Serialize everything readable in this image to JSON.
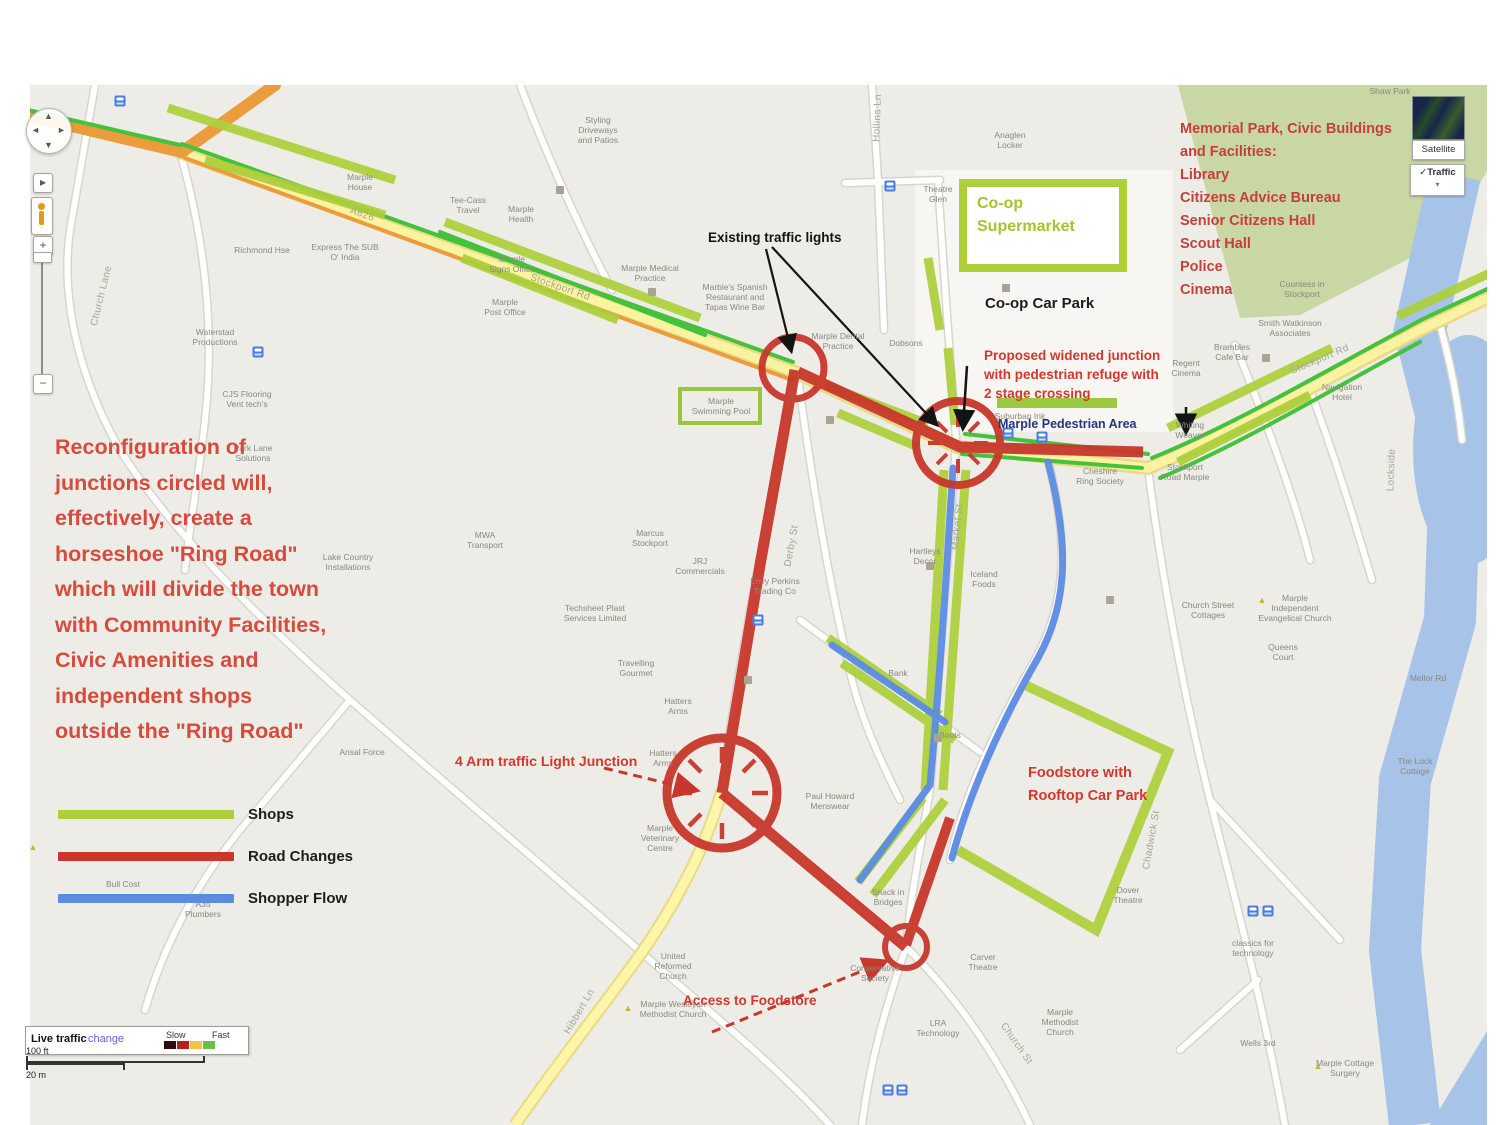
{
  "annotations": {
    "reconfiguration": "Reconfiguration of\njunctions circled will,\neffectively, create a\nhorseshoe \"Ring Road\"\nwhich will divide the town\nwith Community Facilities,\nCivic Amenities and\nindependent shops\noutside the \"Ring Road\"",
    "memorial_park": "Memorial Park, Civic Buildings\nand Facilities:\nLibrary\nCitizens Advice Bureau\nSenior Citizens Hall\nScout Hall\nPolice\nCinema",
    "proposed_junction": "Proposed widened junction\nwith pedestrian refuge with\n2 stage crossing",
    "four_arm_junction": "4 Arm traffic Light Junction",
    "foodstore": "Foodstore with\nRooftop Car Park",
    "access_foodstore": "Access to Foodstore",
    "existing_lights": "Existing traffic lights",
    "coop_supermarket": "Co-op\nSupermarket",
    "coop_car_park": "Co-op Car Park",
    "pedestrian_area": "Marple Pedestrian Area"
  },
  "legend": {
    "items": [
      {
        "label": "Shops",
        "key": "shops"
      },
      {
        "label": "Road Changes",
        "key": "road_changes"
      },
      {
        "label": "Shopper Flow",
        "key": "shopper_flow"
      }
    ]
  },
  "colors": {
    "shops": "#accf3a",
    "road_changes": "#c8372b",
    "shopper_flow": "#5b8ce4",
    "annotation_red": "#d5372c",
    "park_green": "#c8d7a3",
    "water_blue": "#a7c3e8",
    "main_road_yellow": "#fbf3a2",
    "traffic_orange": "#eb9c3c",
    "traffic_green": "#45c13c"
  },
  "controls": {
    "satellite_label": "Satellite",
    "traffic_label": "✓Traffic",
    "dropdown_caret": "▾",
    "pan_up": "▲",
    "pan_down": "▼",
    "pan_left": "◄",
    "pan_right": "►",
    "zoom_in": "+",
    "zoom_out": "−",
    "street_view": "▸"
  },
  "traffic_bar": {
    "title": "Live traffic",
    "link": "change",
    "slow": "Slow",
    "fast": "Fast",
    "swatches": [
      "#2e0d0d",
      "#b81f1f",
      "#f0c541",
      "#6abf4b"
    ]
  },
  "scale": {
    "imperial": "100 ft",
    "metric": "20 m"
  },
  "map_labels": [
    {
      "t": "Styling\nDriveways\nand Patios",
      "x": 598,
      "y": 130
    },
    {
      "t": "Marple\nHouse",
      "x": 360,
      "y": 182
    },
    {
      "t": "Tee-Cass\nTravel",
      "x": 468,
      "y": 205
    },
    {
      "t": "Marple\nHealth",
      "x": 521,
      "y": 214
    },
    {
      "t": "Richmond Hse",
      "x": 262,
      "y": 250
    },
    {
      "t": "Marple\nSigns Office",
      "x": 512,
      "y": 264
    },
    {
      "t": "Express The SUB\nO' India",
      "x": 345,
      "y": 252
    },
    {
      "t": "Marple Medical\nPractice",
      "x": 650,
      "y": 273
    },
    {
      "t": "Marple\nPost Office",
      "x": 505,
      "y": 307
    },
    {
      "t": "Marble's Spanish\nRestaurant and\nTapas Wine Bar",
      "x": 735,
      "y": 297
    },
    {
      "t": "Marple Dental\nPractice",
      "x": 838,
      "y": 341
    },
    {
      "t": "Dobsons",
      "x": 906,
      "y": 343
    },
    {
      "t": "Anaglen\nLocker",
      "x": 1010,
      "y": 140
    },
    {
      "t": "Theatre\nGlen",
      "x": 938,
      "y": 194
    },
    {
      "t": "Shaw Park",
      "x": 1390,
      "y": 91
    },
    {
      "t": "Countess in\nStockport",
      "x": 1302,
      "y": 289
    },
    {
      "t": "Smith Watkinson\nAssociates",
      "x": 1290,
      "y": 328
    },
    {
      "t": "Brambles\nCafe Bar",
      "x": 1232,
      "y": 352
    },
    {
      "t": "Regent\nCinema",
      "x": 1186,
      "y": 368
    },
    {
      "t": "Navigation\nHotel",
      "x": 1342,
      "y": 392
    },
    {
      "t": "Whiting\nWeaver",
      "x": 1190,
      "y": 430
    },
    {
      "t": "Stockport\nRoad Marple",
      "x": 1185,
      "y": 472
    },
    {
      "t": "Suburban Ink",
      "x": 1020,
      "y": 416
    },
    {
      "t": "Cheshire\nRing Society",
      "x": 1100,
      "y": 476
    },
    {
      "t": "Waterstad\nProductions",
      "x": 215,
      "y": 337
    },
    {
      "t": "CJS Flooring\nVent tech's",
      "x": 247,
      "y": 399
    },
    {
      "t": "Park Lane\nSolutions",
      "x": 253,
      "y": 453
    },
    {
      "t": "MWA\nTransport",
      "x": 485,
      "y": 540
    },
    {
      "t": "Marcus\nStockport",
      "x": 650,
      "y": 538
    },
    {
      "t": "JRJ\nCommercials",
      "x": 700,
      "y": 566
    },
    {
      "t": "Techsheet Plast\nServices Limited",
      "x": 595,
      "y": 613
    },
    {
      "t": "Envy Perkins\nTrading Co",
      "x": 775,
      "y": 586
    },
    {
      "t": "Travelling\nGourmet",
      "x": 636,
      "y": 668
    },
    {
      "t": "Hatters\nArms",
      "x": 678,
      "y": 706
    },
    {
      "t": "Hatters\nArms",
      "x": 663,
      "y": 758
    },
    {
      "t": "Lake Country\nInstallations",
      "x": 348,
      "y": 562
    },
    {
      "t": "Ansal Force",
      "x": 362,
      "y": 752
    },
    {
      "t": "Hartleys\nDecor",
      "x": 925,
      "y": 556
    },
    {
      "t": "Iceland\nFoods",
      "x": 984,
      "y": 579
    },
    {
      "t": "Boots",
      "x": 950,
      "y": 735
    },
    {
      "t": "Marple\nVeterinary\nCentre",
      "x": 660,
      "y": 838
    },
    {
      "t": "Paul Howard\nMenswear",
      "x": 830,
      "y": 801
    },
    {
      "t": "Bank",
      "x": 898,
      "y": 673
    },
    {
      "t": "Snack in\nBridges",
      "x": 888,
      "y": 897
    },
    {
      "t": "Conservative\nSociety",
      "x": 875,
      "y": 973
    },
    {
      "t": "Carver\nTheatre",
      "x": 983,
      "y": 962
    },
    {
      "t": "Dover\nTheatre",
      "x": 1128,
      "y": 895
    },
    {
      "t": "Marple\nMethodist\nChurch",
      "x": 1060,
      "y": 1022
    },
    {
      "t": "LRA\nTechnology",
      "x": 938,
      "y": 1028
    },
    {
      "t": "United\nReformed\nChurch",
      "x": 673,
      "y": 966
    },
    {
      "t": "Marple Wesleyan\nMethodist Church",
      "x": 673,
      "y": 1009
    },
    {
      "t": "Church Street\nCottages",
      "x": 1208,
      "y": 610
    },
    {
      "t": "Marple\nIndependent\nEvangelical Church",
      "x": 1295,
      "y": 608
    },
    {
      "t": "Queens\nCourt",
      "x": 1283,
      "y": 652
    },
    {
      "t": "Mellor Rd",
      "x": 1428,
      "y": 678
    },
    {
      "t": "The Lock\nCottage",
      "x": 1415,
      "y": 766
    },
    {
      "t": "classics for\ntechnology",
      "x": 1253,
      "y": 948
    },
    {
      "t": "Marple Cottage\nSurgery",
      "x": 1345,
      "y": 1068
    },
    {
      "t": "Wells 3rd",
      "x": 1258,
      "y": 1043
    },
    {
      "t": "Bull Cost",
      "x": 123,
      "y": 884
    },
    {
      "t": "A35\nPlumbers",
      "x": 203,
      "y": 909
    },
    {
      "t": "Marple\nSwimming Pool",
      "x": 721,
      "y": 406
    },
    {
      "t": "Stockport Rd",
      "x": 560,
      "y": 288,
      "r": 19,
      "cls": "street-label"
    },
    {
      "t": "A626",
      "x": 362,
      "y": 215,
      "r": 19,
      "cls": "street-label"
    },
    {
      "t": "Stockport Rd",
      "x": 1320,
      "y": 360,
      "r": -23,
      "cls": "street-label"
    },
    {
      "t": "Church Lane",
      "x": 102,
      "y": 296,
      "r": -76,
      "cls": "street-label"
    },
    {
      "t": "Hibbert Ln",
      "x": 580,
      "y": 1012,
      "r": -60,
      "cls": "street-label"
    },
    {
      "t": "Derby St",
      "x": 792,
      "y": 546,
      "r": -80,
      "cls": "street-label"
    },
    {
      "t": "Market St",
      "x": 958,
      "y": 527,
      "r": -85,
      "cls": "street-label"
    },
    {
      "t": "Hollins Ln",
      "x": 878,
      "y": 118,
      "r": -88,
      "cls": "street-label"
    },
    {
      "t": "Church St",
      "x": 1016,
      "y": 1044,
      "r": 55,
      "cls": "street-label"
    },
    {
      "t": "Chadwick St",
      "x": 1152,
      "y": 840,
      "r": -80,
      "cls": "street-label"
    },
    {
      "t": "Lockside",
      "x": 1392,
      "y": 470,
      "r": -88,
      "cls": "street-label"
    }
  ],
  "poi_icons": [
    {
      "x": 120,
      "y": 101,
      "type": "bus"
    },
    {
      "x": 258,
      "y": 352,
      "type": "bus"
    },
    {
      "x": 890,
      "y": 186,
      "type": "bus"
    },
    {
      "x": 1008,
      "y": 433,
      "type": "bus"
    },
    {
      "x": 1042,
      "y": 437,
      "type": "bus"
    },
    {
      "x": 1253,
      "y": 911,
      "type": "bus"
    },
    {
      "x": 1268,
      "y": 911,
      "type": "bus"
    },
    {
      "x": 888,
      "y": 1090,
      "type": "bus"
    },
    {
      "x": 902,
      "y": 1090,
      "type": "bus"
    },
    {
      "x": 758,
      "y": 620,
      "type": "bus"
    },
    {
      "x": 560,
      "y": 190,
      "type": "bld"
    },
    {
      "x": 652,
      "y": 292,
      "type": "bld"
    },
    {
      "x": 830,
      "y": 420,
      "type": "bld"
    },
    {
      "x": 930,
      "y": 566,
      "type": "bld"
    },
    {
      "x": 1006,
      "y": 288,
      "type": "bld"
    },
    {
      "x": 748,
      "y": 680,
      "type": "bld"
    },
    {
      "x": 938,
      "y": 738,
      "type": "bld"
    },
    {
      "x": 1266,
      "y": 358,
      "type": "bld"
    },
    {
      "x": 1110,
      "y": 600,
      "type": "bld"
    },
    {
      "x": 628,
      "y": 1008,
      "type": "tri"
    },
    {
      "x": 1318,
      "y": 1066,
      "type": "tri"
    },
    {
      "x": 1262,
      "y": 600,
      "type": "tri"
    },
    {
      "x": 33,
      "y": 847,
      "type": "tri"
    }
  ]
}
